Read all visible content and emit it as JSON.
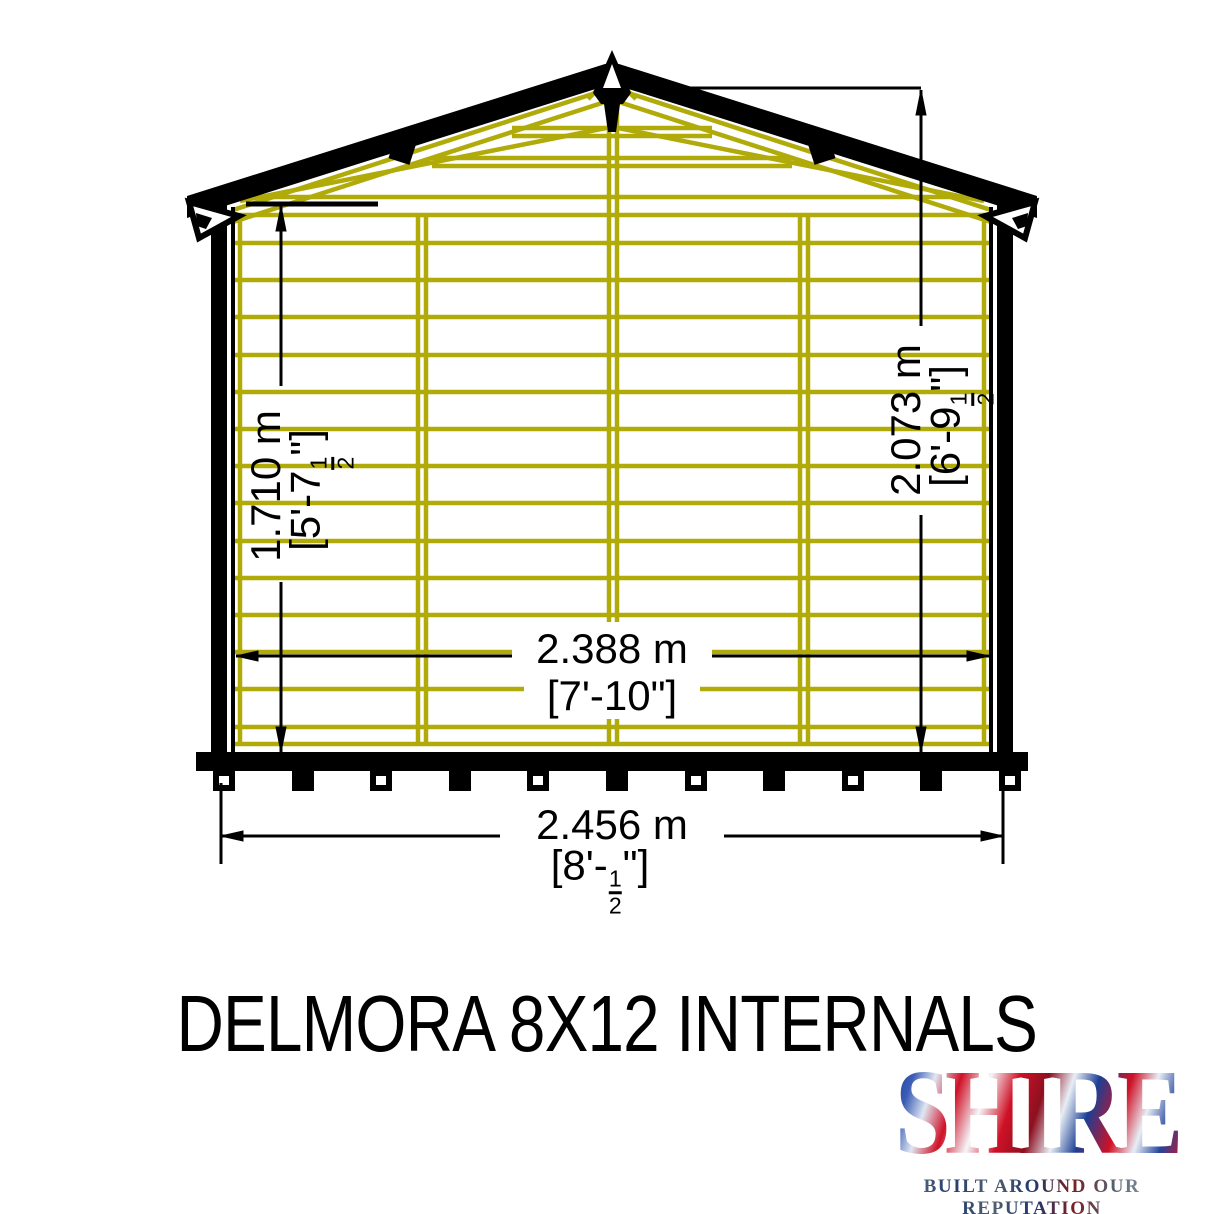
{
  "title": "DELMORA 8X12 INTERNALS",
  "logo": {
    "name": "SHIRE",
    "tagline": "BUILT AROUND OUR REPUTATION"
  },
  "dimensions": {
    "eaves_height": {
      "metric": "1.710 m",
      "imp_prefix": "[5'-7",
      "frac_num": "1",
      "frac_den": "2",
      "imp_suffix": "\"]"
    },
    "ridge_height": {
      "metric": "2.073 m",
      "imp_prefix": "[6'-9",
      "frac_num": "1",
      "frac_den": "2",
      "imp_suffix": "\"]"
    },
    "internal_width": {
      "metric": "2.388 m",
      "imperial": "[7'-10\"]"
    },
    "external_width": {
      "metric": "2.456 m",
      "imp_prefix": "[8'-",
      "frac_num": "1",
      "frac_den": "2",
      "imp_suffix": "\"]"
    }
  },
  "colors": {
    "framing": "#b0ab08",
    "outline": "#000000",
    "logo_red": "#cf1126",
    "logo_blue": "#1c3f94"
  }
}
